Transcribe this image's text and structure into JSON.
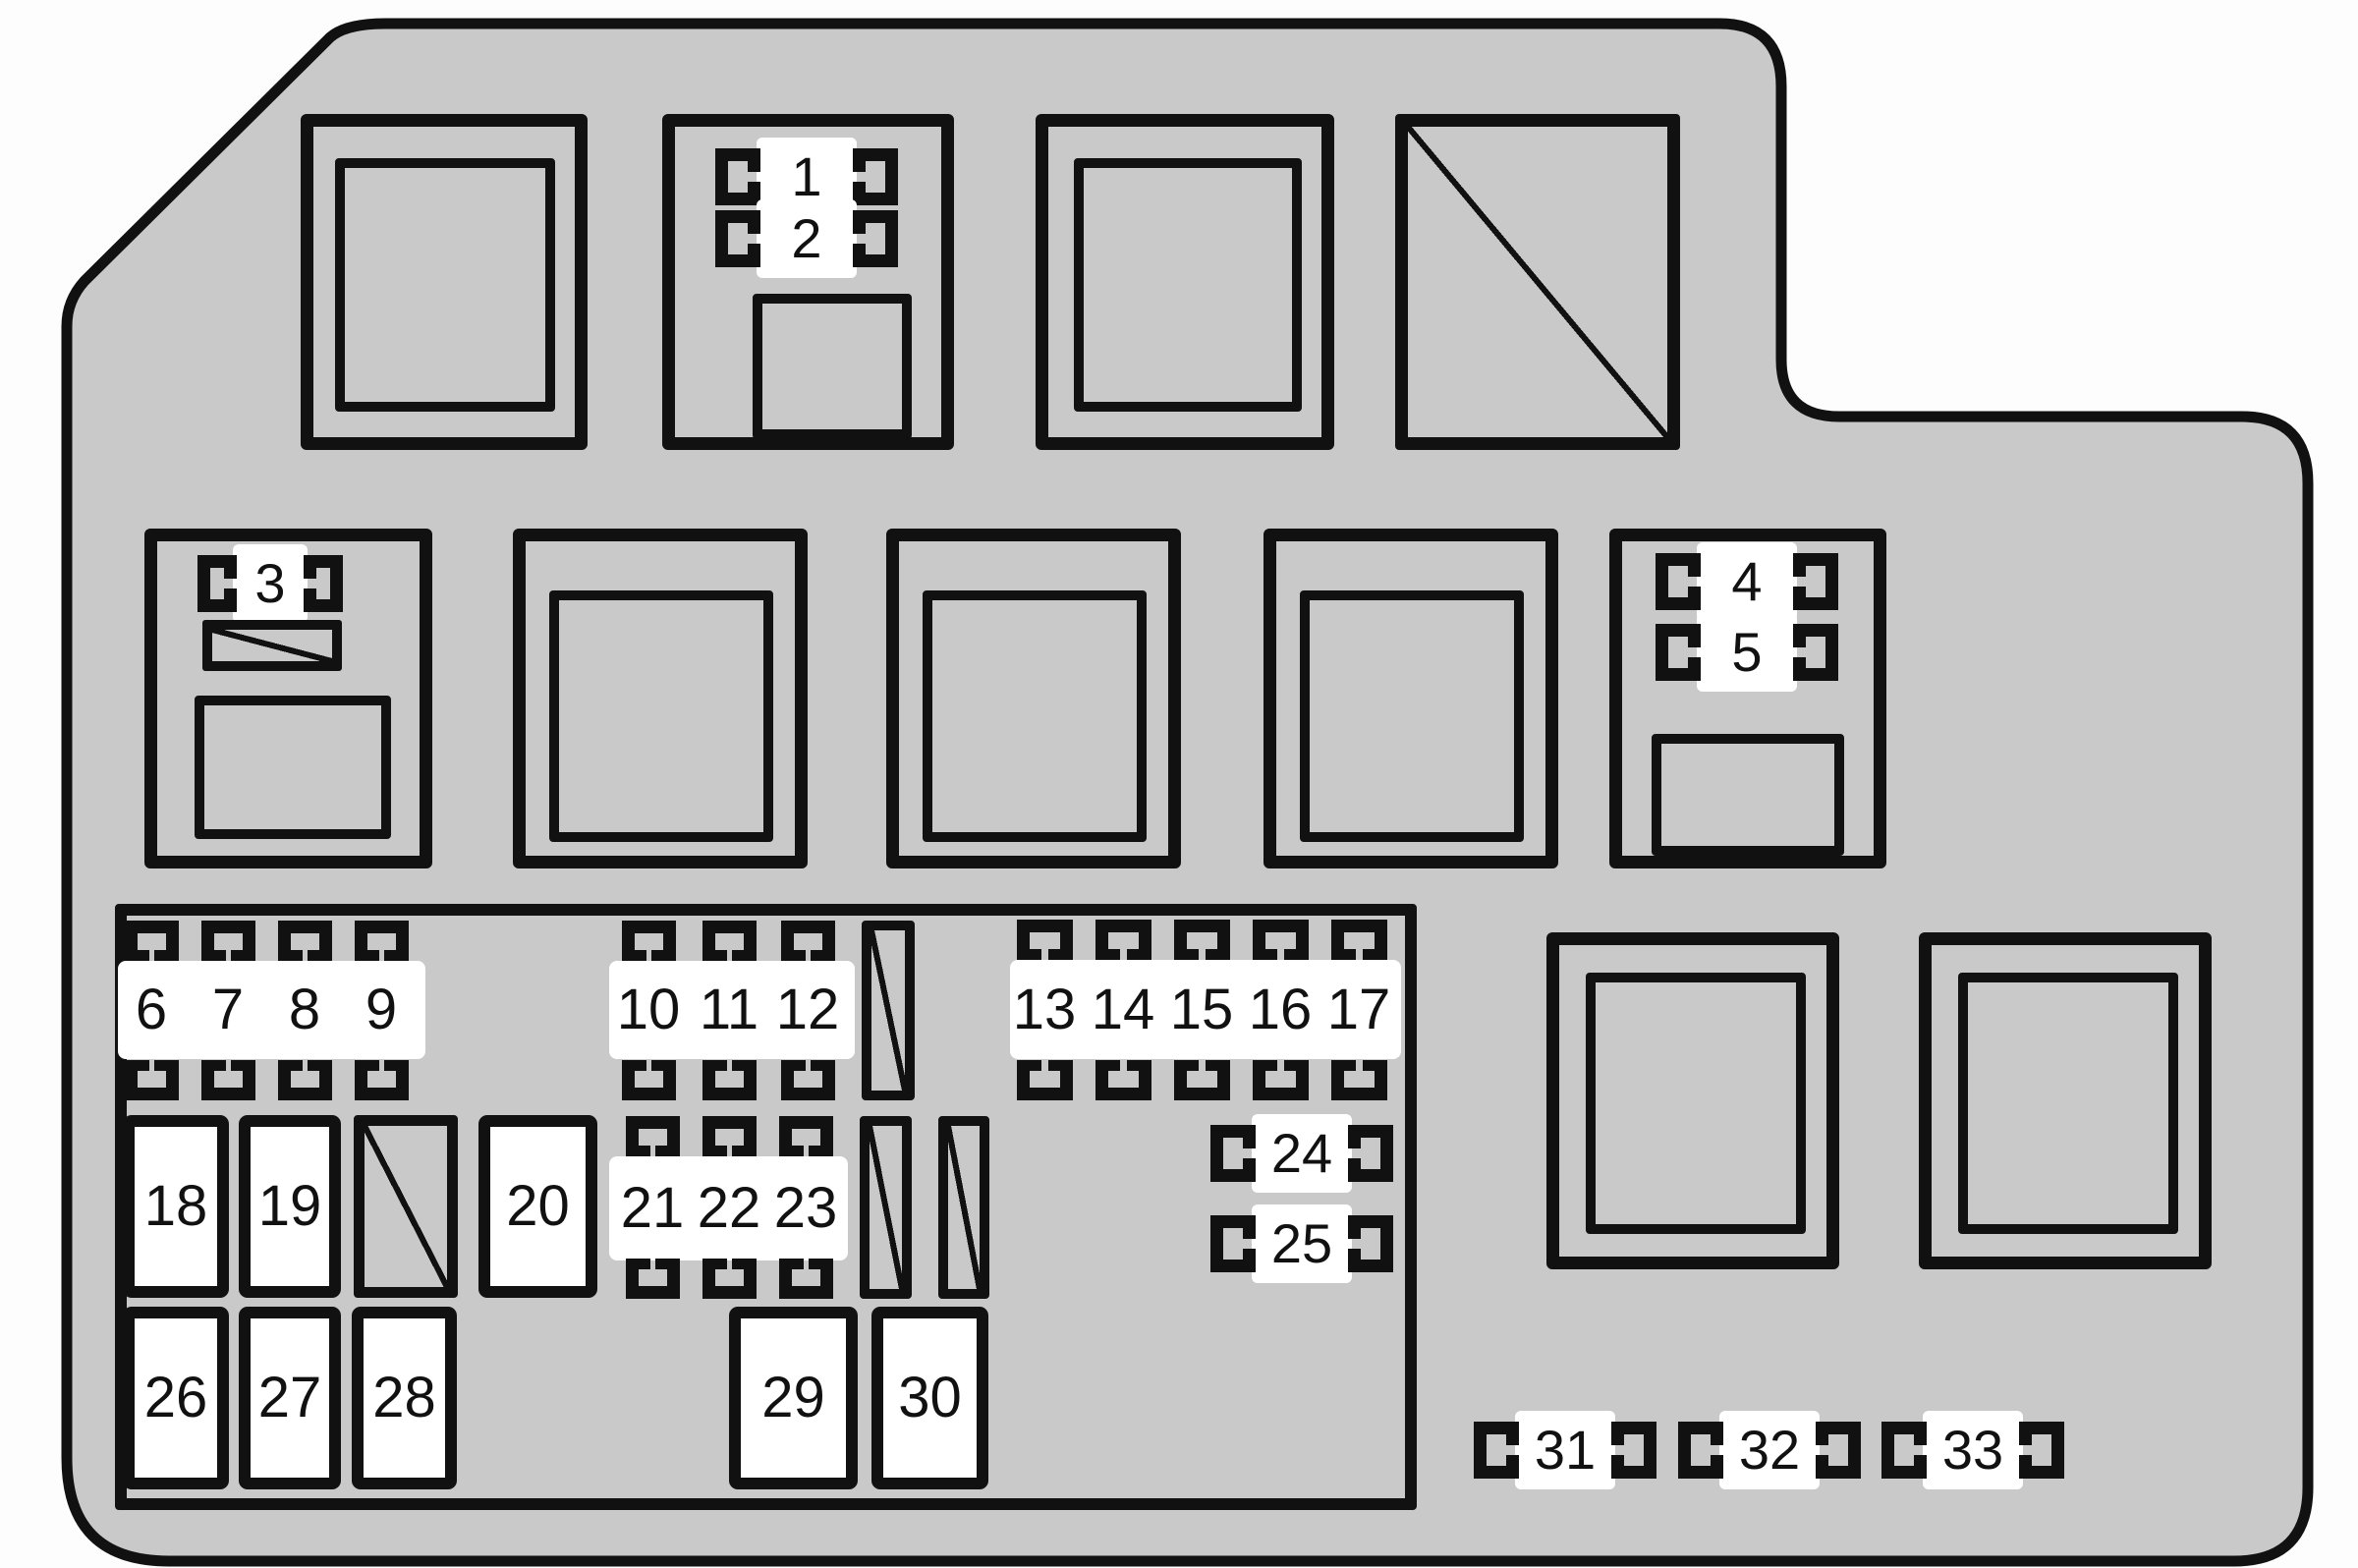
{
  "diagram_title": "",
  "colors": {
    "body_fill": "#c9c9c9",
    "line": "#111111",
    "slot_fill": "#ffffff",
    "page_background": "#fdfdfd"
  },
  "labels": {
    "f1": "1",
    "f2": "2",
    "f3": "3",
    "f4": "4",
    "f5": "5",
    "f6": "6",
    "f7": "7",
    "f8": "8",
    "f9": "9",
    "f10": "10",
    "f11": "11",
    "f12": "12",
    "f13": "13",
    "f14": "14",
    "f15": "15",
    "f16": "16",
    "f17": "17",
    "f18": "18",
    "f19": "19",
    "f20": "20",
    "f21": "21",
    "f22": "22",
    "f23": "23",
    "f24": "24",
    "f25": "25",
    "f26": "26",
    "f27": "27",
    "f28": "28",
    "f29": "29",
    "f30": "30",
    "f31": "31",
    "f32": "32",
    "f33": "33"
  },
  "groups": [
    {
      "name": "relay-box-with-fuses-1-2",
      "fuses": [
        "1",
        "2"
      ]
    },
    {
      "name": "relay-box-with-fuse-3",
      "fuses": [
        "3"
      ]
    },
    {
      "name": "relay-box-with-fuses-4-5",
      "fuses": [
        "4",
        "5"
      ]
    },
    {
      "name": "mini-fuse-row",
      "fuses": [
        "6",
        "7",
        "8",
        "9"
      ]
    },
    {
      "name": "mini-fuse-row",
      "fuses": [
        "10",
        "11",
        "12"
      ]
    },
    {
      "name": "mini-fuse-row",
      "fuses": [
        "13",
        "14",
        "15",
        "16",
        "17"
      ]
    },
    {
      "name": "mini-fuse-row",
      "fuses": [
        "21",
        "22",
        "23"
      ]
    },
    {
      "name": "single-fuses",
      "fuses": [
        "24",
        "25"
      ]
    },
    {
      "name": "white-slots",
      "fuses": [
        "18",
        "19",
        "20",
        "26",
        "27",
        "28",
        "29",
        "30"
      ]
    },
    {
      "name": "bottom-right-fuse-row",
      "fuses": [
        "31",
        "32",
        "33"
      ]
    }
  ]
}
